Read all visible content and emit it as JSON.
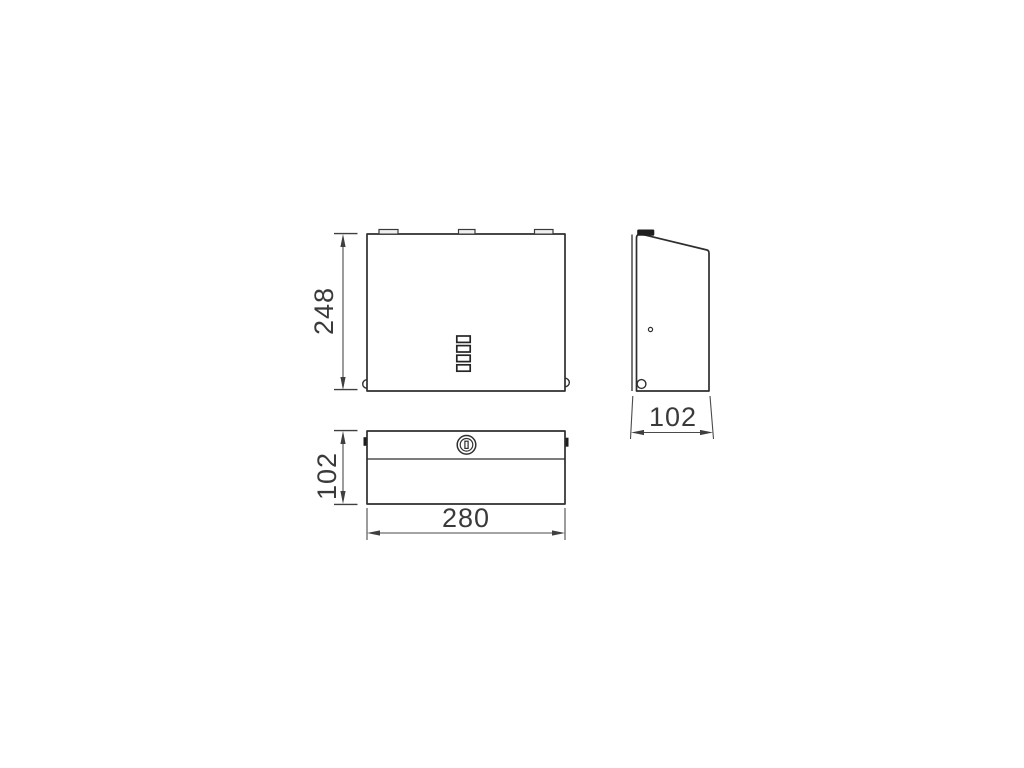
{
  "drawing": {
    "dimensions": {
      "front_height": "248",
      "side_depth": "102",
      "bottom_depth": "102",
      "bottom_width": "280"
    },
    "colors": {
      "background": "#ffffff",
      "outline": "#2e2e2e",
      "dimension_line": "#4a4a4a",
      "dimension_text": "#3a3a3a",
      "tab_fill": "#1e1e1e"
    }
  }
}
